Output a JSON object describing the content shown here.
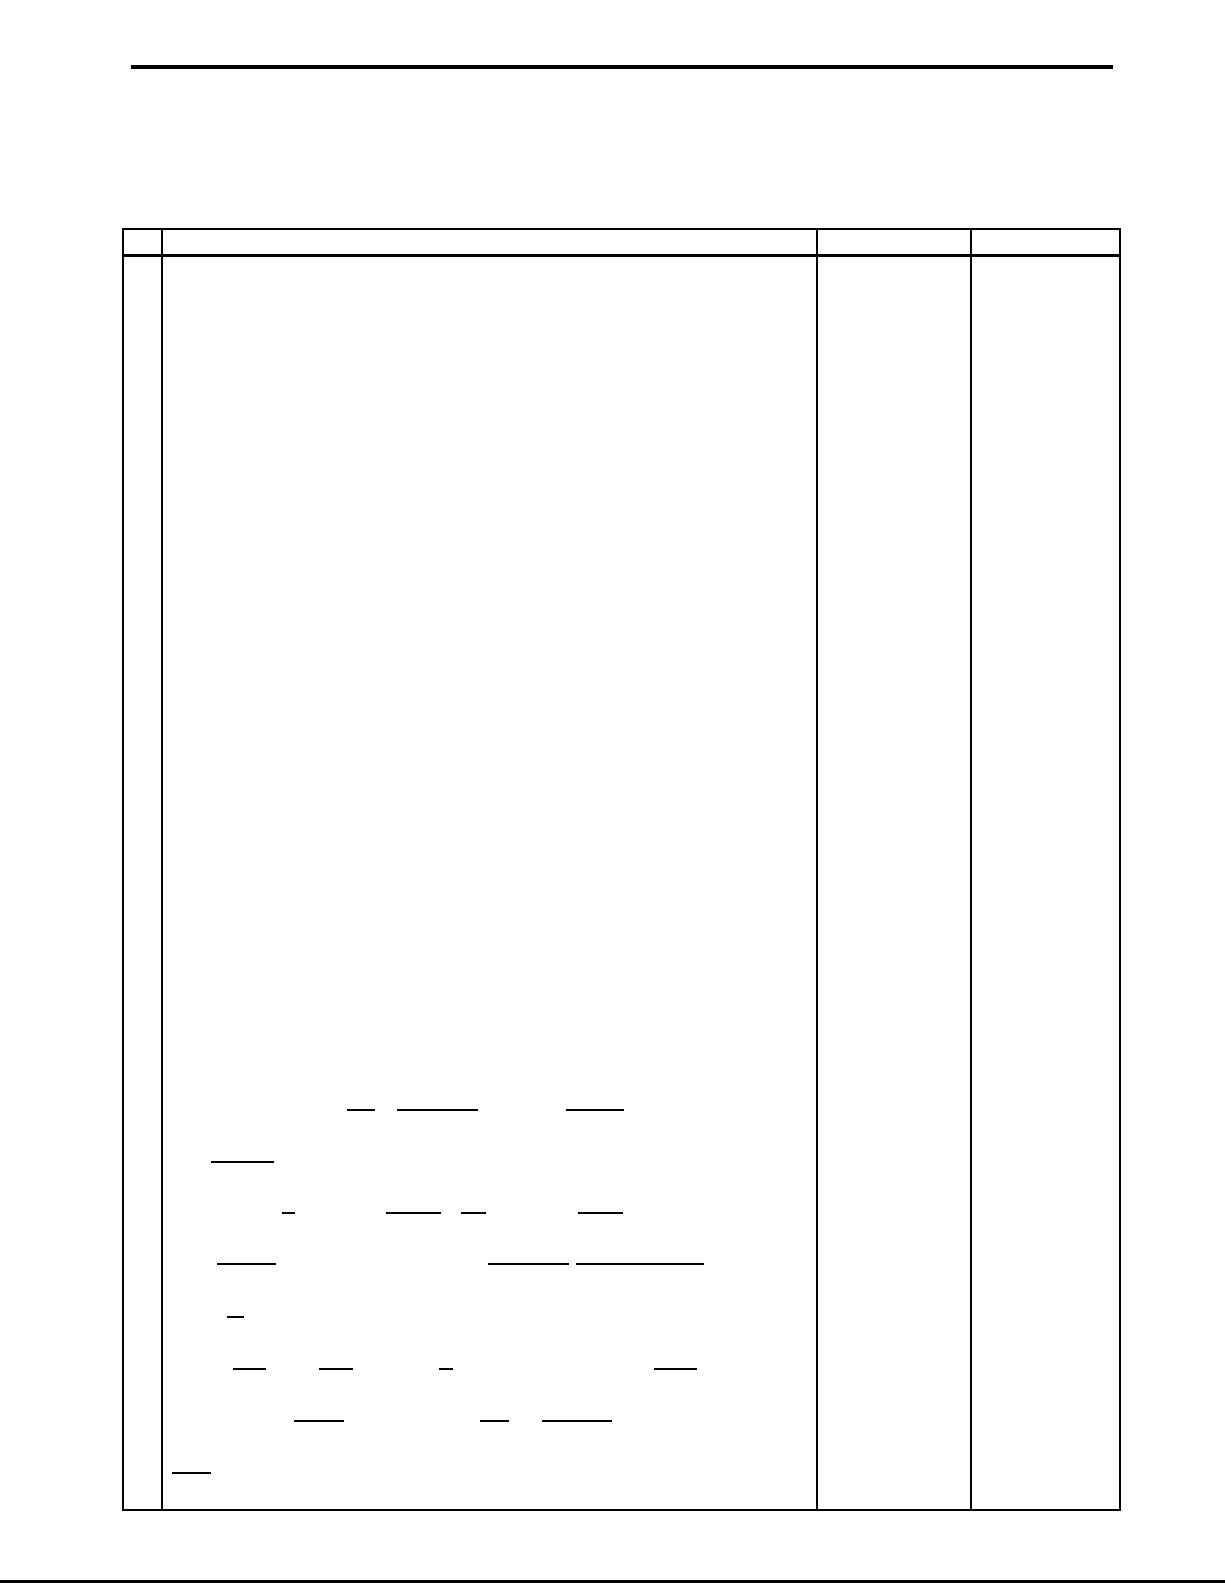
{
  "page": {
    "width": 1225,
    "height": 1585,
    "background": "#ffffff",
    "line_color": "#000000"
  },
  "top_rule": {
    "x": 131,
    "y": 65,
    "width": 982,
    "thickness": 4
  },
  "bottom_rule": {
    "x": 0,
    "y": 1580,
    "width": 1225,
    "thickness": 3
  },
  "table": {
    "x": 122,
    "y": 228,
    "width": 999,
    "height": 1283,
    "border_thickness": 2,
    "header_height": 26,
    "header_separator_thickness": 3,
    "column_dividers_x": [
      161,
      816,
      970
    ],
    "columns": [
      {
        "name": "number-column",
        "x": 122,
        "width": 39,
        "visible_text": ""
      },
      {
        "name": "content-column",
        "x": 161,
        "width": 655,
        "visible_text": ""
      },
      {
        "name": "answer-column-1",
        "x": 816,
        "width": 154,
        "visible_text": ""
      },
      {
        "name": "answer-column-2",
        "x": 970,
        "width": 151,
        "visible_text": ""
      }
    ]
  },
  "formula_marks": {
    "thickness": 2,
    "color": "#000000",
    "lines": [
      {
        "x": 347,
        "y": 1109,
        "width": 28
      },
      {
        "x": 397,
        "y": 1109,
        "width": 81
      },
      {
        "x": 566,
        "y": 1109,
        "width": 58
      },
      {
        "x": 211,
        "y": 1161,
        "width": 63
      },
      {
        "x": 282,
        "y": 1212,
        "width": 13
      },
      {
        "x": 386,
        "y": 1212,
        "width": 55
      },
      {
        "x": 461,
        "y": 1212,
        "width": 25
      },
      {
        "x": 578,
        "y": 1212,
        "width": 45
      },
      {
        "x": 217,
        "y": 1263,
        "width": 59
      },
      {
        "x": 488,
        "y": 1263,
        "width": 81
      },
      {
        "x": 576,
        "y": 1263,
        "width": 128
      },
      {
        "x": 227,
        "y": 1316,
        "width": 17
      },
      {
        "x": 233,
        "y": 1368,
        "width": 33
      },
      {
        "x": 319,
        "y": 1368,
        "width": 34
      },
      {
        "x": 439,
        "y": 1368,
        "width": 14
      },
      {
        "x": 654,
        "y": 1368,
        "width": 43
      },
      {
        "x": 294,
        "y": 1420,
        "width": 50
      },
      {
        "x": 480,
        "y": 1420,
        "width": 29
      },
      {
        "x": 542,
        "y": 1420,
        "width": 70
      },
      {
        "x": 172,
        "y": 1472,
        "width": 39
      }
    ]
  }
}
